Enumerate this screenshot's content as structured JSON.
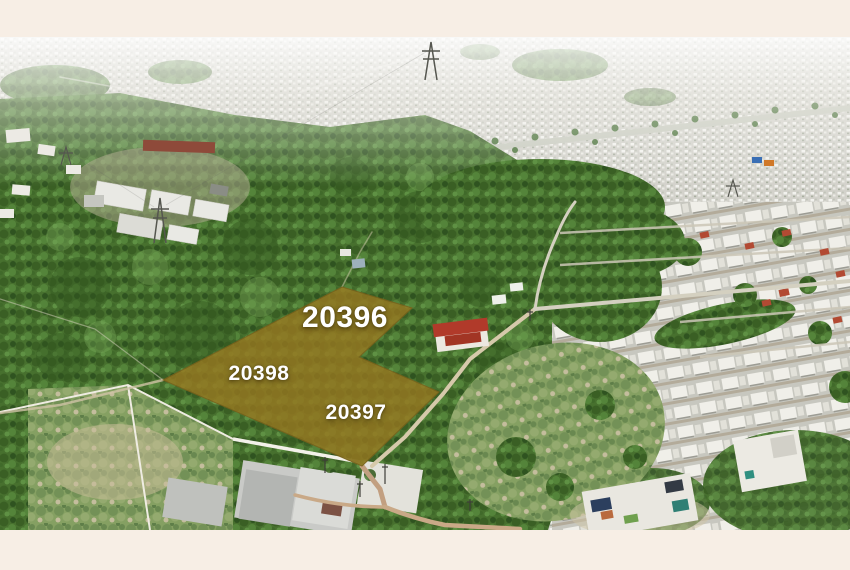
{
  "frame": {
    "background_color": "#f7eee5"
  },
  "parcel_overlay": {
    "fill_color": "#9a7820",
    "outline_color": "#7d611a",
    "label_color": "#ffffff",
    "polygon_points": "342,250 412,271 359,320 439,355 362,429 163,343",
    "labels": [
      {
        "text": "20396"
      },
      {
        "text": "20398"
      },
      {
        "text": "20397"
      }
    ]
  }
}
